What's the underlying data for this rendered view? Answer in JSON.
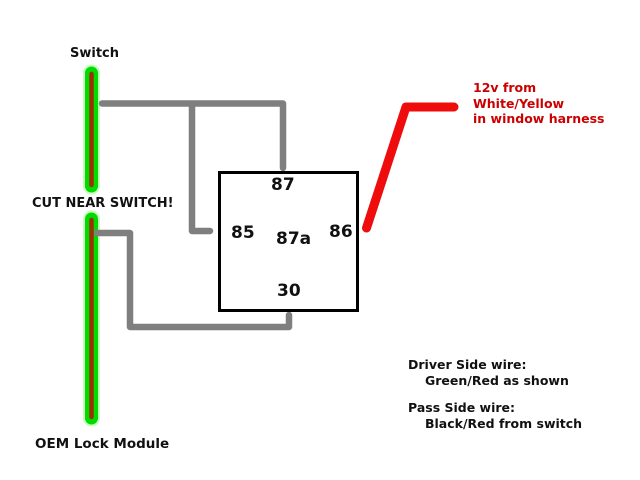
{
  "labels": {
    "switch": "Switch",
    "cut_near_switch": "CUT NEAR SWITCH!",
    "oem_lock_module": "OEM Lock Module"
  },
  "relay": {
    "pin_top": "87",
    "pin_left": "85",
    "pin_center": "87a",
    "pin_right": "86",
    "pin_bottom": "30"
  },
  "red_note": {
    "line1": "12v from",
    "line2": "White/Yellow",
    "line3": "in window harness"
  },
  "side_notes": {
    "driver_title": "Driver Side wire:",
    "driver_detail": "Green/Red as shown",
    "pass_title": "Pass Side wire:",
    "pass_detail": "Black/Red from switch"
  },
  "colors": {
    "wire-green": "#00dc00",
    "wire-green-halo": "#8dff78",
    "wire-stripe-red": "#9c3000",
    "wire-gray": "#7f7f7f",
    "wire-red": "#ee0c0c",
    "text-red": "#cc0000",
    "text-black": "#111111"
  }
}
